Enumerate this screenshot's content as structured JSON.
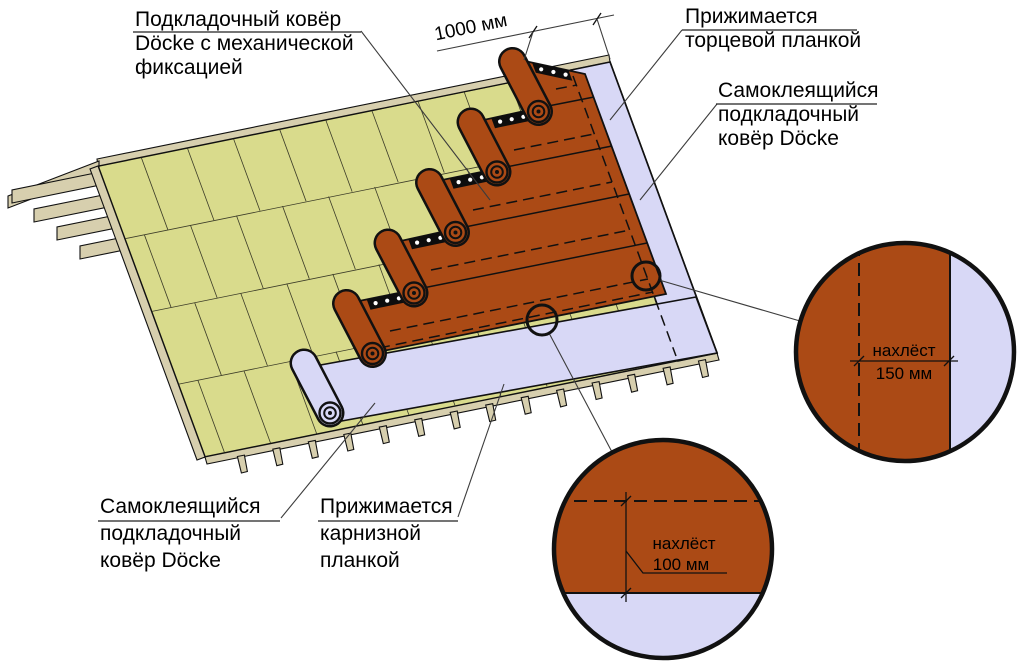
{
  "diagram": {
    "dimension_label": "1000 мм",
    "labels": {
      "underlay_mechanical": [
        "Подкладочный ковёр",
        "Döcke с механической",
        "фиксацией"
      ],
      "pressed_end_strip": [
        "Прижимается",
        "торцевой планкой"
      ],
      "self_adhesive_right": [
        "Самоклеящийся",
        "подкладочный",
        "ковёр Döcke"
      ],
      "self_adhesive_left": [
        "Самоклеящийся",
        "подкладочный",
        "ковёр Döcke"
      ],
      "pressed_eaves_strip": [
        "Прижимается",
        "карнизной",
        "планкой"
      ]
    },
    "details": {
      "side_overlap": [
        "нахлёст",
        "150 мм"
      ],
      "bottom_overlap": [
        "нахлёст",
        "100 мм"
      ]
    },
    "colors": {
      "deck": "#d9db8c",
      "wood": "#d7cfae",
      "underlay": "#ab4a15",
      "membrane": "#d8d8f6",
      "leader": "#3c3c3c"
    }
  }
}
